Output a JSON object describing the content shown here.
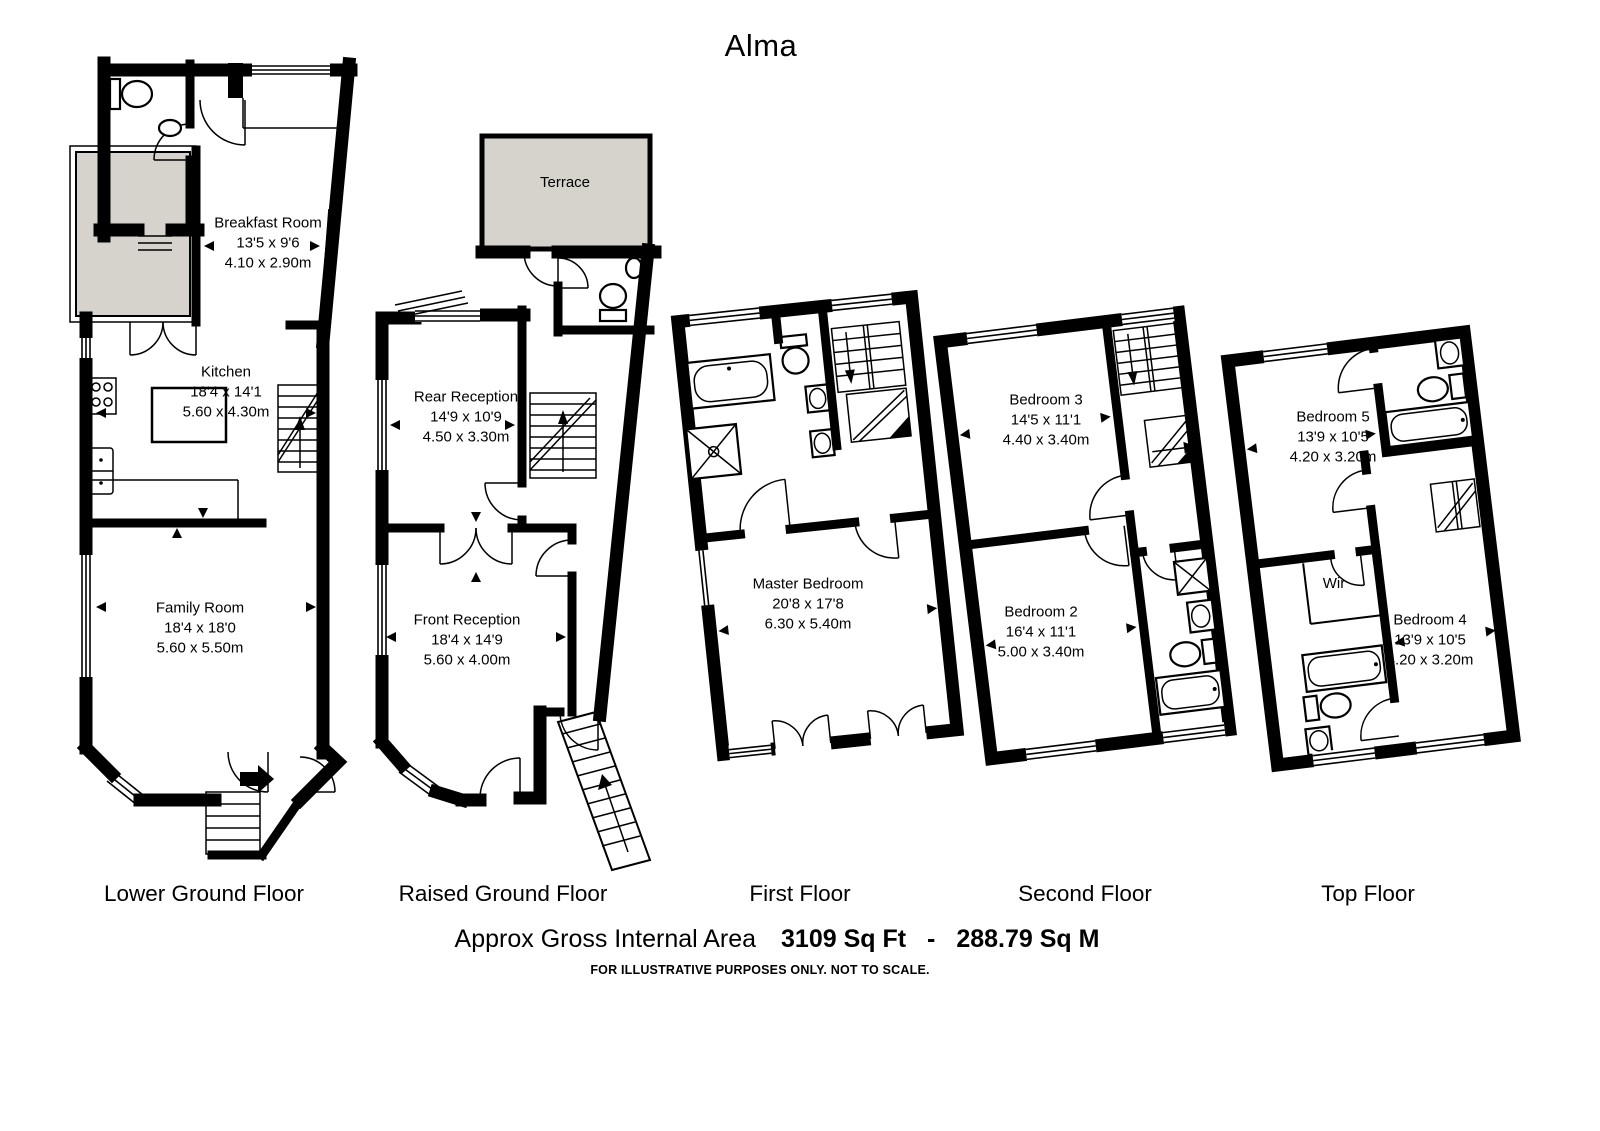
{
  "title": "Alma",
  "floors": [
    {
      "label": "Lower Ground Floor",
      "rooms": [
        {
          "name": "Breakfast Room",
          "imperial": "13'5 x 9'6",
          "metric": "4.10 x 2.90m"
        },
        {
          "name": "Kitchen",
          "imperial": "18'4 x 14'1",
          "metric": "5.60 x 4.30m"
        },
        {
          "name": "Family Room",
          "imperial": "18'4 x 18'0",
          "metric": "5.60 x 5.50m"
        }
      ]
    },
    {
      "label": "Raised Ground Floor",
      "rooms": [
        {
          "name": "Terrace",
          "imperial": "",
          "metric": ""
        },
        {
          "name": "Rear Reception",
          "imperial": "14'9 x 10'9",
          "metric": "4.50 x 3.30m"
        },
        {
          "name": "Front Reception",
          "imperial": "18'4 x 14'9",
          "metric": "5.60 x 4.00m"
        }
      ]
    },
    {
      "label": "First Floor",
      "rooms": [
        {
          "name": "Master Bedroom",
          "imperial": "20'8 x 17'8",
          "metric": "6.30 x 5.40m"
        }
      ]
    },
    {
      "label": "Second Floor",
      "rooms": [
        {
          "name": "Bedroom 3",
          "imperial": "14'5 x 11'1",
          "metric": "4.40 x 3.40m"
        },
        {
          "name": "Bedroom 2",
          "imperial": "16'4 x 11'1",
          "metric": "5.00 x 3.40m"
        }
      ]
    },
    {
      "label": "Top Floor",
      "rooms": [
        {
          "name": "Bedroom 5",
          "imperial": "13'9 x 10'5",
          "metric": "4.20 x 3.20m"
        },
        {
          "name": "Wir",
          "imperial": "",
          "metric": ""
        },
        {
          "name": "Bedroom 4",
          "imperial": "13'9 x 10'5",
          "metric": "4.20 x 3.20m"
        }
      ]
    }
  ],
  "footer": {
    "area_label": "Approx Gross Internal Area",
    "area_sqft": "3109 Sq Ft",
    "area_sep": "-",
    "area_sqm": "288.79  Sq M",
    "disclaimer": "FOR ILLUSTRATIVE PURPOSES ONLY. NOT TO SCALE."
  },
  "colors": {
    "wall": "#000000",
    "terrace_fill": "#d6d3cd",
    "background": "#ffffff"
  }
}
